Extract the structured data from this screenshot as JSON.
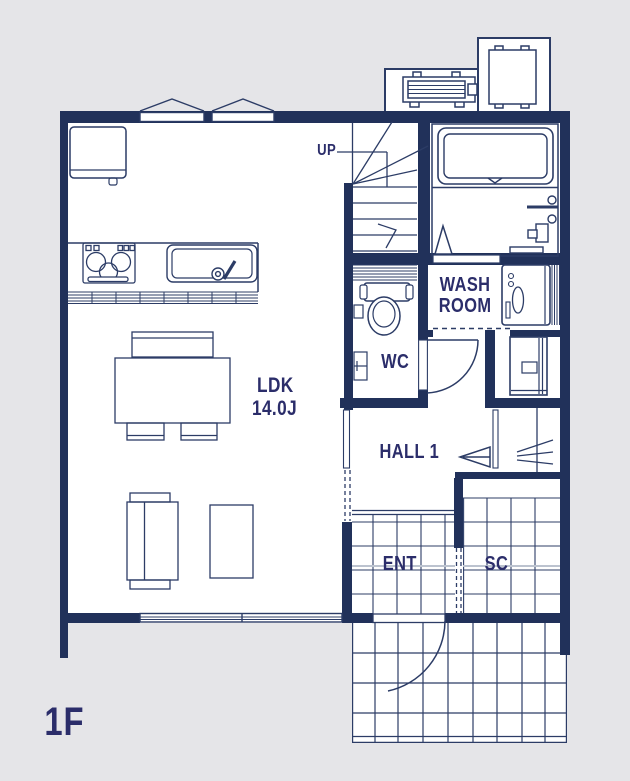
{
  "title": "First floor plan",
  "floor_label": "1F",
  "colors": {
    "wall": "#21315a",
    "line": "#2c3c66",
    "label_text": "#2b2d6a",
    "outside_bg": "#e5e5e8",
    "floor": "#ffffff",
    "step_line": "#bcc3cf"
  },
  "labels": {
    "stairs_up": "UP",
    "ldk_name": "LDK",
    "ldk_size": "14.0J",
    "wc": "WC",
    "washroom_line1": "WASH",
    "washroom_line2": "ROOM",
    "hall": "HALL 1",
    "entrance": "ENT",
    "shoe_closet": "SC"
  }
}
